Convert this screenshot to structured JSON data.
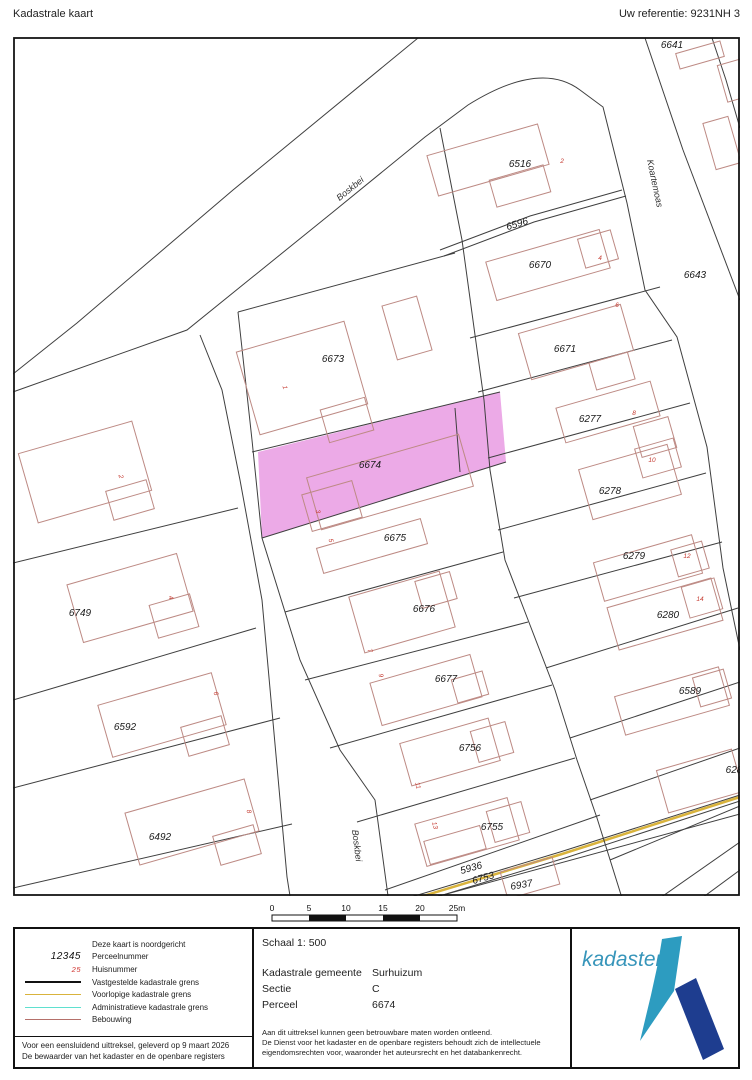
{
  "header": {
    "title": "Kadastrale kaart",
    "reference": "Uw referentie: 9231NH 3"
  },
  "map": {
    "highlight_color": "#ecaae7",
    "highlighted_parcel": "6674",
    "parcel_labels": [
      {
        "t": "6641",
        "x": 672,
        "y": 48,
        "r": 0
      },
      {
        "t": "6516",
        "x": 520,
        "y": 167,
        "r": 0
      },
      {
        "t": "6596",
        "x": 518,
        "y": 227,
        "r": -17
      },
      {
        "t": "6670",
        "x": 540,
        "y": 268,
        "r": 0
      },
      {
        "t": "6643",
        "x": 695,
        "y": 278,
        "r": 0
      },
      {
        "t": "6671",
        "x": 565,
        "y": 352,
        "r": 0
      },
      {
        "t": "6673",
        "x": 333,
        "y": 362,
        "r": 0
      },
      {
        "t": "6277",
        "x": 590,
        "y": 422,
        "r": 0
      },
      {
        "t": "6674",
        "x": 370,
        "y": 468,
        "r": 0
      },
      {
        "t": "6278",
        "x": 610,
        "y": 494,
        "r": 0
      },
      {
        "t": "6675",
        "x": 395,
        "y": 541,
        "r": 0
      },
      {
        "t": "6279",
        "x": 634,
        "y": 559,
        "r": 0
      },
      {
        "t": "6749",
        "x": 80,
        "y": 616,
        "r": 0
      },
      {
        "t": "6676",
        "x": 424,
        "y": 612,
        "r": 0
      },
      {
        "t": "6280",
        "x": 668,
        "y": 618,
        "r": 0
      },
      {
        "t": "6677",
        "x": 446,
        "y": 682,
        "r": 0
      },
      {
        "t": "6589",
        "x": 690,
        "y": 694,
        "r": 0
      },
      {
        "t": "6592",
        "x": 125,
        "y": 730,
        "r": 0
      },
      {
        "t": "6756",
        "x": 470,
        "y": 751,
        "r": 0
      },
      {
        "t": "628",
        "x": 734,
        "y": 773,
        "r": 0
      },
      {
        "t": "6755",
        "x": 492,
        "y": 830,
        "r": 0
      },
      {
        "t": "6492",
        "x": 160,
        "y": 840,
        "r": 0
      },
      {
        "t": "5936",
        "x": 472,
        "y": 871,
        "r": -16
      },
      {
        "t": "6753",
        "x": 484,
        "y": 881,
        "r": -16
      },
      {
        "t": "6937",
        "x": 522,
        "y": 888,
        "r": -10
      }
    ],
    "house_numbers": [
      {
        "t": "2",
        "x": 119,
        "y": 477,
        "r": 75
      },
      {
        "t": "4",
        "x": 169,
        "y": 598,
        "r": 75
      },
      {
        "t": "6",
        "x": 214,
        "y": 694,
        "r": 75
      },
      {
        "t": "8",
        "x": 247,
        "y": 812,
        "r": 75
      },
      {
        "t": "1",
        "x": 283,
        "y": 388,
        "r": 75
      },
      {
        "t": "3",
        "x": 316,
        "y": 512,
        "r": 75
      },
      {
        "t": "5",
        "x": 329,
        "y": 541,
        "r": 75
      },
      {
        "t": "7",
        "x": 368,
        "y": 651,
        "r": 75
      },
      {
        "t": "9",
        "x": 379,
        "y": 676,
        "r": 75
      },
      {
        "t": "11",
        "x": 416,
        "y": 786,
        "r": 75
      },
      {
        "t": "13",
        "x": 433,
        "y": 826,
        "r": 75
      },
      {
        "t": "2",
        "x": 562,
        "y": 163,
        "r": 0
      },
      {
        "t": "4",
        "x": 600,
        "y": 260,
        "r": 0
      },
      {
        "t": "6",
        "x": 617,
        "y": 307,
        "r": 0
      },
      {
        "t": "8",
        "x": 634,
        "y": 415,
        "r": 0
      },
      {
        "t": "10",
        "x": 652,
        "y": 462,
        "r": 0
      },
      {
        "t": "12",
        "x": 687,
        "y": 558,
        "r": 0
      },
      {
        "t": "14",
        "x": 700,
        "y": 601,
        "r": 0
      }
    ],
    "street_labels": [
      {
        "t": "Boskbei",
        "x": 352,
        "y": 191,
        "r": -39
      },
      {
        "t": "Koartemoas",
        "x": 652,
        "y": 184,
        "r": 78
      },
      {
        "t": "Boskbei",
        "x": 354,
        "y": 846,
        "r": 83
      }
    ]
  },
  "scalebar": {
    "ticks": [
      "0",
      "5",
      "10",
      "15",
      "20",
      "25m"
    ]
  },
  "legend": {
    "north_note": "Deze kaart is noordgericht",
    "items": [
      {
        "symbol": "text",
        "symbol_text": "12345",
        "label": "Perceelnummer"
      },
      {
        "symbol": "text-red",
        "symbol_text": "25",
        "label": "Huisnummer"
      },
      {
        "symbol": "line",
        "color": "#111111",
        "thickness": 2.5,
        "label": "Vastgestelde kadastrale grens"
      },
      {
        "symbol": "line",
        "color": "#d9b33c",
        "thickness": 1.5,
        "label": "Voorlopige kadastrale grens"
      },
      {
        "symbol": "line",
        "color": "#5fe0cf",
        "thickness": 1.5,
        "label": "Administratieve kadastrale grens"
      },
      {
        "symbol": "line",
        "color": "#b5706a",
        "thickness": 1,
        "label": "Bebouwing"
      }
    ]
  },
  "footer": {
    "schaal": "Schaal 1: 500",
    "rows": [
      {
        "label": "Kadastrale gemeente",
        "value": "Surhuizum"
      },
      {
        "label": "Sectie",
        "value": "C"
      },
      {
        "label": "Perceel",
        "value": "6674"
      }
    ],
    "disclaimer": [
      "Aan dit uittreksel kunnen geen betrouwbare maten worden ontleend.",
      "De Dienst voor het kadaster en de openbare registers behoudt zich de intellectuele",
      "eigendomsrechten voor, waaronder het auteursrecht en het databankenrecht."
    ],
    "left_note": [
      "Voor een eensluidend uittreksel, geleverd op 9 maart 2026",
      "De bewaarder van het kadaster en de openbare registers"
    ]
  },
  "logo": {
    "text": "kadaster",
    "text_color": "#3795ba",
    "mark_teal": "#2d9cc0",
    "mark_navy": "#1e3d8f"
  }
}
